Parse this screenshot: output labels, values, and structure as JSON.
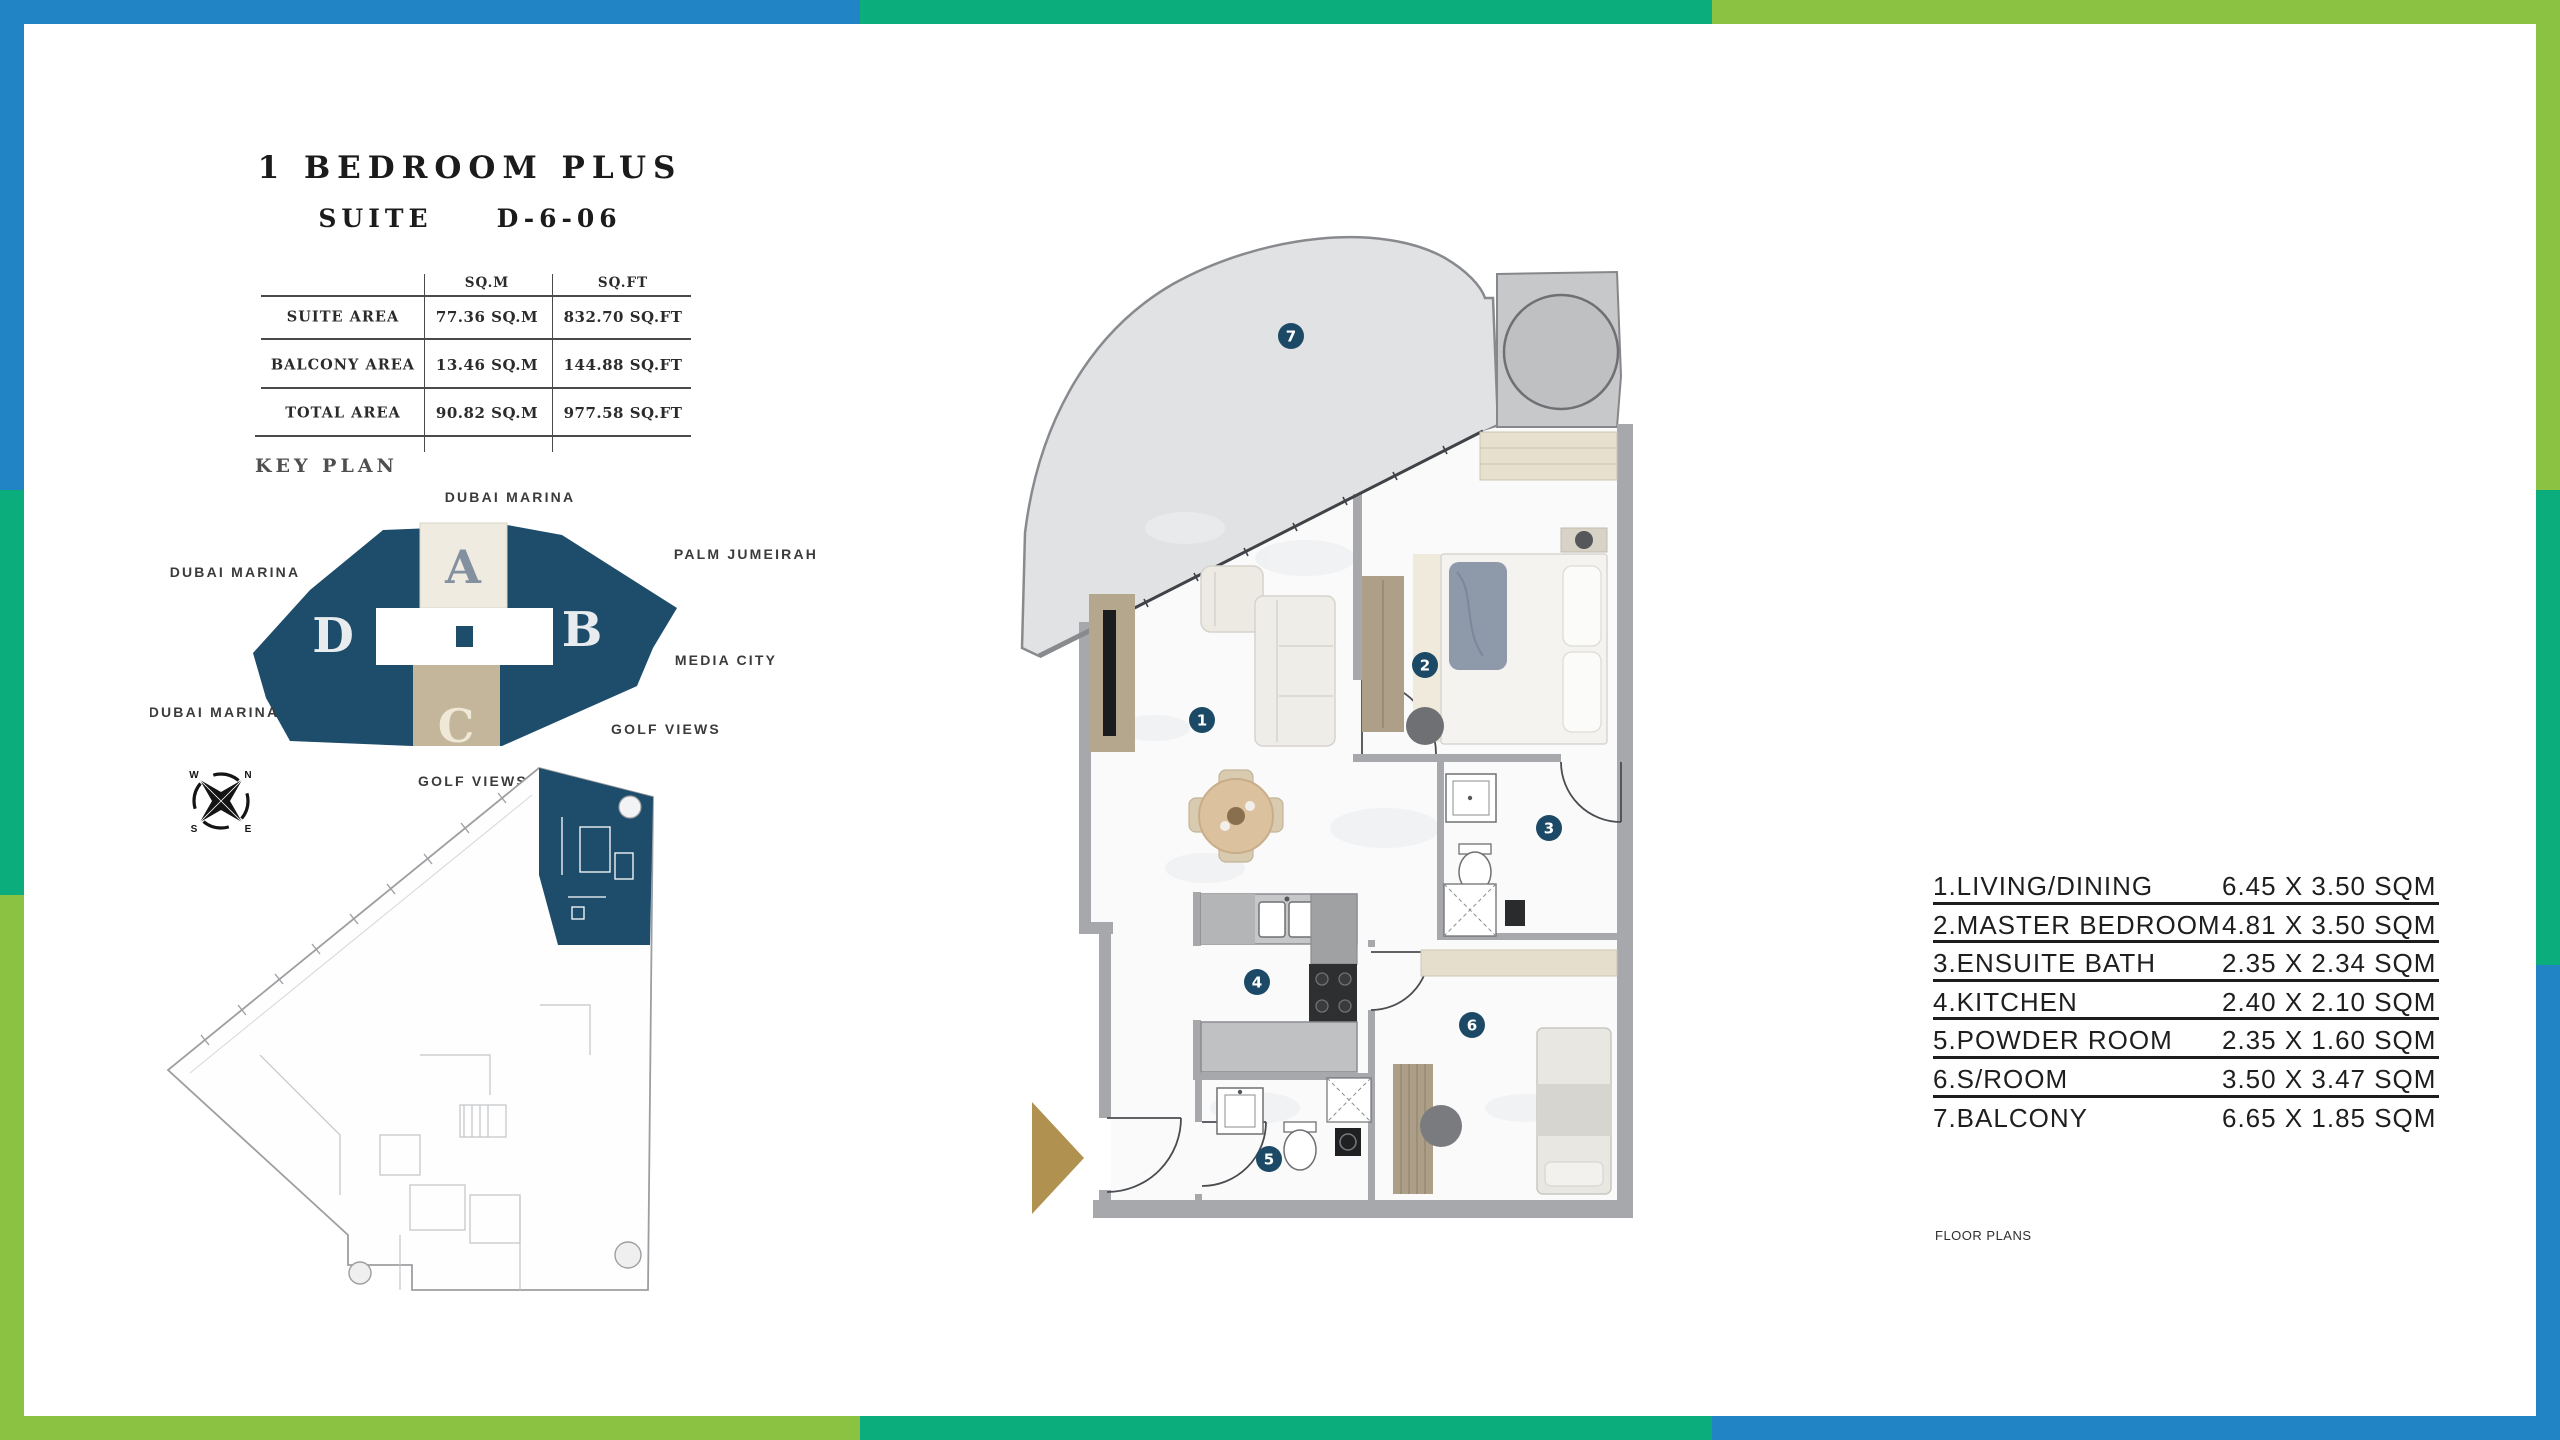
{
  "header": {
    "title": "1 BEDROOM PLUS",
    "suite_label": "SUITE",
    "suite_number": "D-6-06"
  },
  "area_table": {
    "col_headers": {
      "sqm": "SQ.M",
      "sqft": "SQ.FT"
    },
    "rows": [
      {
        "label": "SUITE AREA",
        "sqm": "77.36 SQ.M",
        "sqft": "832.70 SQ.FT"
      },
      {
        "label": "BALCONY AREA",
        "sqm": "13.46 SQ.M",
        "sqft": "144.88 SQ.FT"
      },
      {
        "label": "TOTAL AREA",
        "sqm": "90.82 SQ.M",
        "sqft": "977.58 SQ.FT"
      }
    ]
  },
  "key_plan": {
    "heading": "KEY PLAN",
    "sections": {
      "a": "A",
      "b": "B",
      "c": "C",
      "d": "D"
    },
    "labels": {
      "top": "DUBAI MARINA",
      "left": "DUBAI MARINA",
      "bottom_left": "DUBAI MARINA",
      "right_top": "PALM JUMEIRAH",
      "right_mid": "MEDIA CITY",
      "right_bottom": "GOLF VIEWS",
      "bottom_center": "GOLF VIEWS"
    }
  },
  "compass": {
    "nw": "W",
    "ne": "N",
    "sw": "S",
    "se": "E"
  },
  "floor_plan": {
    "room_numbers": [
      "1",
      "2",
      "3",
      "4",
      "5",
      "6",
      "7"
    ]
  },
  "legend": {
    "rows": [
      {
        "label": "1.LIVING/DINING",
        "dim": "6.45 X 3.50 SQM"
      },
      {
        "label": "2.MASTER BEDROOM",
        "dim": "4.81 X 3.50 SQM"
      },
      {
        "label": "3.ENSUITE BATH",
        "dim": "2.35 X 2.34 SQM"
      },
      {
        "label": "4.KITCHEN",
        "dim": "2.40 X 2.10 SQM"
      },
      {
        "label": "5.POWDER ROOM",
        "dim": "2.35 X 1.60 SQM"
      },
      {
        "label": "6.S/ROOM",
        "dim": "3.50 X 3.47 SQM"
      },
      {
        "label": "7.BALCONY",
        "dim": "6.65 X 1.85 SQM"
      }
    ]
  },
  "footer": {
    "note": "FLOOR PLANS"
  },
  "colors": {
    "frame_blue": "#2185C5",
    "frame_emerald": "#0BAD7D",
    "frame_lime": "#8BC242",
    "keyplan_navy": "#1E4D6B",
    "block_a_cream": "#EFEBE0",
    "block_c_tan": "#C3B69A",
    "badge_navy": "#1C4A66",
    "entry_arrow_gold": "#B0914F",
    "balcony_gray": "#E0E2E4"
  }
}
